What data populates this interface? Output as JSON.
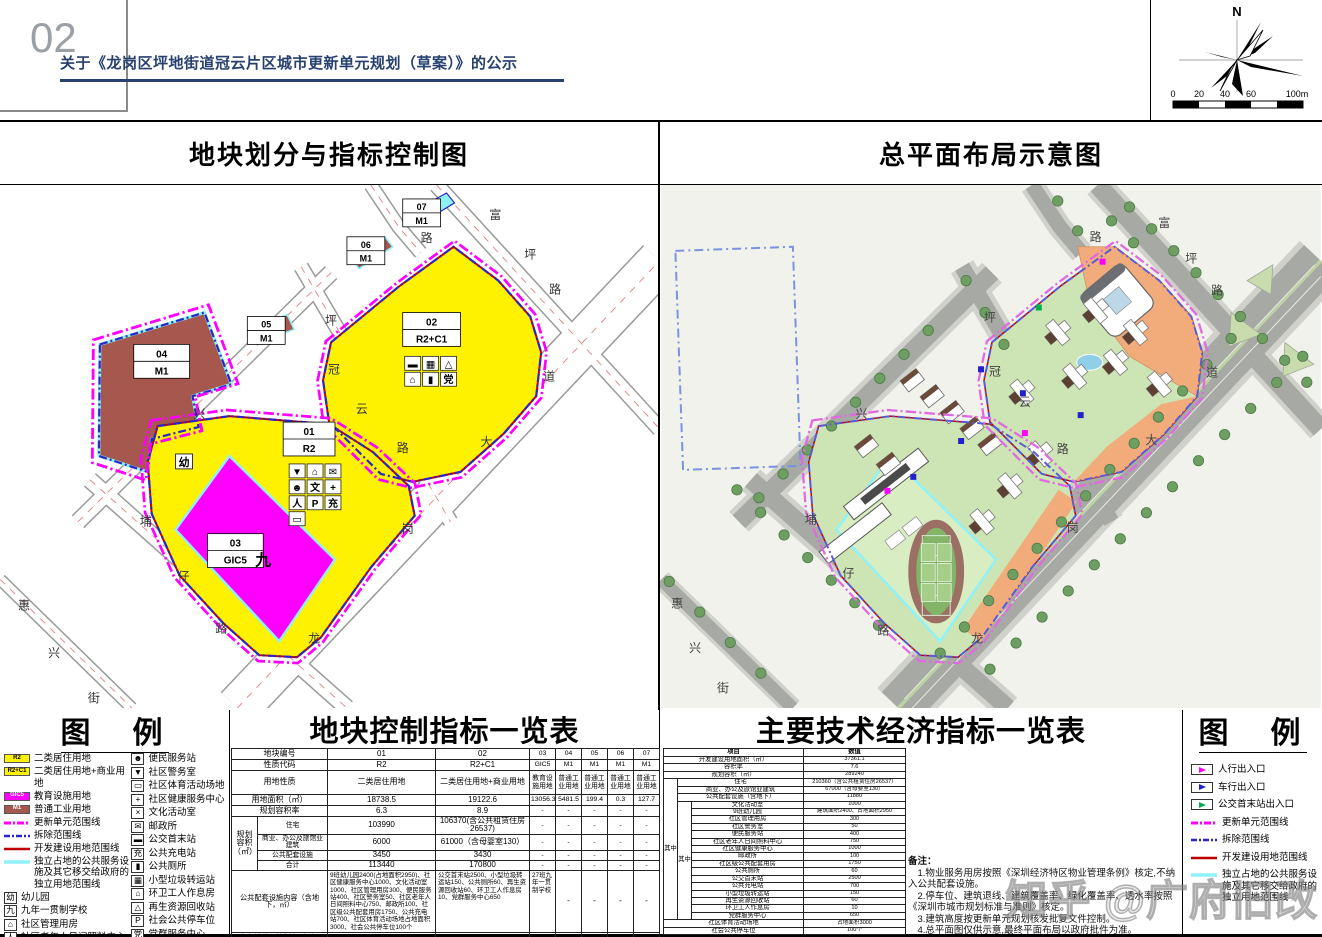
{
  "page": {
    "number": "02",
    "title": "关于《龙岗区坪地街道冠云片区城市更新单元规划（草案）》的公示"
  },
  "compass": {
    "north": "N",
    "scale_ticks": [
      "0",
      "20",
      "40",
      "60",
      "100m"
    ]
  },
  "left_map": {
    "title": "地块划分与指标控制图",
    "plots": [
      {
        "id": "01",
        "code": "R2"
      },
      {
        "id": "02",
        "code": "R2+C1"
      },
      {
        "id": "03",
        "code": "GIC5"
      },
      {
        "id": "04",
        "code": "M1"
      },
      {
        "id": "05",
        "code": "M1"
      },
      {
        "id": "06",
        "code": "M1"
      },
      {
        "id": "07",
        "code": "M1"
      }
    ],
    "school_marks": {
      "kindergarten": "幼",
      "nine_year": "九"
    },
    "plot01_icons": [
      "▼",
      "⌂",
      "✉",
      "☻",
      "文",
      "+",
      "人",
      "P",
      "充",
      "▭"
    ],
    "plot02_icons": [
      "▬",
      "▦",
      "△",
      "⌂",
      "▮",
      "党"
    ]
  },
  "right_map": {
    "title": "总平面布局示意图"
  },
  "map_labels": {
    "chars": [
      "富",
      "坪",
      "路",
      "路",
      "坪",
      "冠",
      "云",
      "路",
      "兴",
      "道",
      "大",
      "岗",
      "龙",
      "埔",
      "仔",
      "路",
      "惠",
      "兴",
      "街"
    ]
  },
  "colors": {
    "residential": "#FFF200",
    "education": "#FF00FF",
    "industry": "#A6574E",
    "unit_boundary": "#FF00FF",
    "demolish_boundary": "#2A25C8",
    "development_boundary": "#C00000",
    "independent_land": "#8FF2F8",
    "title_navy": "#27406e"
  },
  "legend_left": {
    "title": "图　例",
    "area_items": [
      {
        "code": "R2",
        "color": "#FFF200",
        "text_color": "#000",
        "label": "二类居住用地"
      },
      {
        "code": "R2+C1",
        "color": "#FFF200",
        "text_color": "#000",
        "label": "二类居住用地+商业用地"
      },
      {
        "code": "GIC5",
        "color": "#FF00FF",
        "text_color": "#fff",
        "label": "教育设施用地"
      },
      {
        "code": "M1",
        "color": "#A6574E",
        "text_color": "#fff",
        "label": "普通工业用地"
      }
    ],
    "line_items": [
      {
        "style": "magenta-dashdot",
        "label": "更新单元范围线"
      },
      {
        "style": "blue-dashdot",
        "label": "拆除范围线"
      },
      {
        "style": "red-solid",
        "label": "开发建设用地范围线"
      },
      {
        "style": "cyan-solid",
        "label": "独立占地的公共服务设施及其它移交给政府的独立用地范围线"
      }
    ],
    "boxed_items": [
      {
        "glyph": "幼",
        "label": "幼儿园"
      },
      {
        "glyph": "九",
        "label": "九年一贯制学校"
      },
      {
        "glyph": "⌂",
        "label": "社区管理用房"
      },
      {
        "glyph": "人",
        "label": "社区老年人日间照料中心"
      }
    ],
    "plot_id_item": {
      "top": "01",
      "bottom": "R2",
      "label_top": "地块编号",
      "label_bottom": "用地性质"
    },
    "facility_items": [
      {
        "glyph": "☻",
        "label": "便民服务站"
      },
      {
        "glyph": "▼",
        "label": "社区警务室"
      },
      {
        "glyph": "▭",
        "label": "社区体育活动场地"
      },
      {
        "glyph": "+",
        "label": "社区健康服务中心"
      },
      {
        "glyph": "×",
        "label": "文化活动室"
      },
      {
        "glyph": "✉",
        "label": "邮政所"
      },
      {
        "glyph": "▬",
        "label": "公交首末站"
      },
      {
        "glyph": "充",
        "label": "公共充电站"
      },
      {
        "glyph": "▮",
        "label": "公共厕所"
      },
      {
        "glyph": "▦",
        "label": "小型垃圾转运站"
      },
      {
        "glyph": "⌂",
        "label": "环卫工人作息房"
      },
      {
        "glyph": "△",
        "label": "再生资源回收站"
      },
      {
        "glyph": "P",
        "label": "社会公共停车位"
      },
      {
        "glyph": "党",
        "label": "党群服务中心"
      }
    ]
  },
  "plot_table": {
    "title": "地块控制指标一览表",
    "simple_rows": [
      {
        "label": "地块编号",
        "cells": [
          "01",
          "02",
          "03",
          "04",
          "05",
          "06",
          "07"
        ]
      },
      {
        "label": "性质代码",
        "cells": [
          "R2",
          "R2+C1",
          "GIC5",
          "M1",
          "M1",
          "M1",
          "M1"
        ]
      },
      {
        "label": "用地性质",
        "cells": [
          "二类居住用地",
          "二类居住用地+商业用地",
          "教育设施用地",
          "普通工业用地",
          "普通工业用地",
          "普通工业用地",
          "普通工业用地"
        ]
      },
      {
        "label": "用地面积（㎡）",
        "cells": [
          "18738.5",
          "19122.6",
          "13056.3",
          "5481.5",
          "199.4",
          "0.3",
          "127.7"
        ]
      },
      {
        "label": "规划容积率",
        "cells": [
          "6.3",
          "8.9",
          "-",
          "-",
          "-",
          "-",
          "-"
        ]
      }
    ],
    "volume_group": {
      "label": "规划容积（㎡）",
      "rows": [
        {
          "label": "住宅",
          "cells": [
            "103990",
            "106370(含公共租赁住房26537)",
            "-",
            "-",
            "-",
            "-",
            "-"
          ]
        },
        {
          "label": "商业、办公及旅馆业建筑",
          "cells": [
            "6000",
            "61000（含母婴室130）",
            "-",
            "-",
            "-",
            "-",
            "-"
          ]
        },
        {
          "label": "公共配套设施",
          "cells": [
            "3450",
            "3430",
            "-",
            "-",
            "-",
            "-",
            "-"
          ]
        },
        {
          "label": "合计",
          "cells": [
            "113440",
            "170800",
            "-",
            "-",
            "-",
            "-",
            "-"
          ]
        }
      ]
    },
    "facility_row": {
      "label": "公共配套设施内容（含地下，㎡）",
      "cells": [
        "9班幼儿园2400(占地面积2950)、社区健康服务中心1000、文化活动室1000、社区管理用房300、便民服务站400、社区警务室50、社区老年人日间照料中心750、邮政所100、社区级公共配套用房1750、公共充电站700、社区体育活动场地占地面积3000、社会公共停车位100个",
        "公交首末站2500、小型垃圾转运站150、公共厕所60、再生资源回收站60、环卫工人作息房10、党群服务中心650",
        "27班九年一贯制学校",
        "-",
        "-",
        "-",
        "-"
      ]
    },
    "runoff_row": {
      "label": "年径流总量控制率（%）",
      "cells": [
        "66",
        "66",
        "67",
        "65",
        "-",
        "-",
        "-"
      ]
    },
    "remark_row": {
      "label": "备注",
      "cells": [
        "拆除重建",
        "拆除重建",
        "拆除重建",
        "拆除重建",
        "拆除重建",
        "拆除重建",
        "拆除重建"
      ]
    }
  },
  "tech_table": {
    "title": "主要技术经济指标一览表",
    "header": {
      "item": "项目",
      "value": "数值"
    },
    "top_rows": [
      {
        "label": "开发建设用地面积（㎡）",
        "value": "37361.1"
      },
      {
        "label": "容积率",
        "value": "7.6"
      },
      {
        "label": "规划容积（㎡）",
        "value": "289240"
      }
    ],
    "among_label": "其中",
    "level1_rows": [
      {
        "label": "住宅",
        "value": "210360（含公共租赁住房26537）"
      },
      {
        "label": "商业、办公及旅馆业建筑",
        "value": "67000（含母婴室130）"
      },
      {
        "label": "公共配套设施（含地下）",
        "value": "11880"
      }
    ],
    "level2_rows": [
      {
        "label": "文化活动室",
        "value": "1000"
      },
      {
        "label": "9班幼儿园",
        "value": "建筑面积2400、占地面积2950"
      },
      {
        "label": "社区管理用房",
        "value": "300"
      },
      {
        "label": "社区警务室",
        "value": "50"
      },
      {
        "label": "便民服务站",
        "value": "400"
      },
      {
        "label": "社区老年人日间照料中心",
        "value": "750"
      },
      {
        "label": "社区健康服务中心",
        "value": "1000"
      },
      {
        "label": "邮政所",
        "value": "100"
      },
      {
        "label": "社区级公共配套用房",
        "value": "1750"
      },
      {
        "label": "公共厕所",
        "value": "60"
      },
      {
        "label": "公交首末站",
        "value": "2500"
      },
      {
        "label": "公共充电站",
        "value": "700"
      },
      {
        "label": "小型垃圾转运站",
        "value": "150"
      },
      {
        "label": "再生资源回收站",
        "value": "60"
      },
      {
        "label": "环卫工人作息房",
        "value": "10"
      },
      {
        "label": "党群服务中心",
        "value": "650"
      }
    ],
    "bottom_rows": [
      {
        "label": "社区体育活动场地",
        "value": "占地面积3000"
      },
      {
        "label": "社会公共停车位",
        "value": "100个"
      }
    ],
    "notes_title": "备注：",
    "notes": [
      "1.物业服务用房按照《深圳经济特区物业管理条例》核定,不纳入公共配套设施。",
      "2.停车位、建筑退线、建筑覆盖率、绿化覆盖率、透水率按照《深圳市城市规划标准与准则》核定。",
      "3.建筑高度按更新单元规划核发批复文件控制。",
      "4.总平面图仅供示意,最终平面布局以政府批件为准。"
    ]
  },
  "legend_right": {
    "title": "图　例",
    "arrow_items": [
      {
        "color": "#FF00FF",
        "label": "人行出入口"
      },
      {
        "color": "#2222CC",
        "label": "车行出入口"
      },
      {
        "color": "#00B050",
        "label": "公交首末站出入口"
      }
    ],
    "line_items": [
      {
        "style": "magenta-dashdot",
        "label": "更新单元范围线"
      },
      {
        "style": "blue-dashdot",
        "label": "拆除范围线"
      },
      {
        "style": "red-solid",
        "label": "开发建设用地范围线"
      },
      {
        "style": "cyan-solid",
        "label": "独立占地的公共服务设施及其它移交给政府的独立用地范围线"
      }
    ]
  },
  "watermark": "知乎 @广府旧改"
}
